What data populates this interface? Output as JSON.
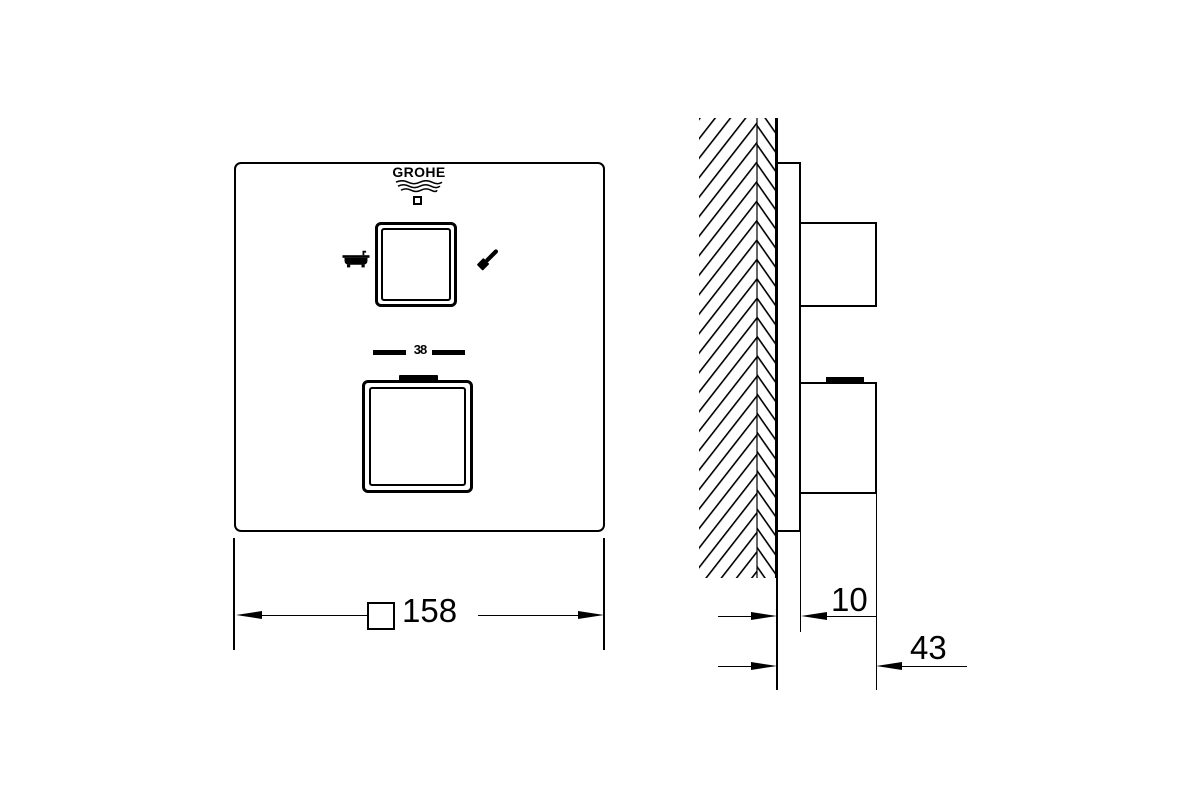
{
  "brand": {
    "logo_text": "GROHE"
  },
  "front_view": {
    "temperature_stop": "38",
    "left_icon": "bathtub",
    "right_icon": "hand-shower",
    "upper_control": "diverter-knob",
    "lower_control": "thermostat-knob"
  },
  "dimensions": {
    "front_width": "158",
    "front_width_prefix_symbol": "square",
    "plate_depth": "10",
    "total_depth": "43"
  },
  "colors": {
    "line": "#000000",
    "background": "#ffffff"
  }
}
